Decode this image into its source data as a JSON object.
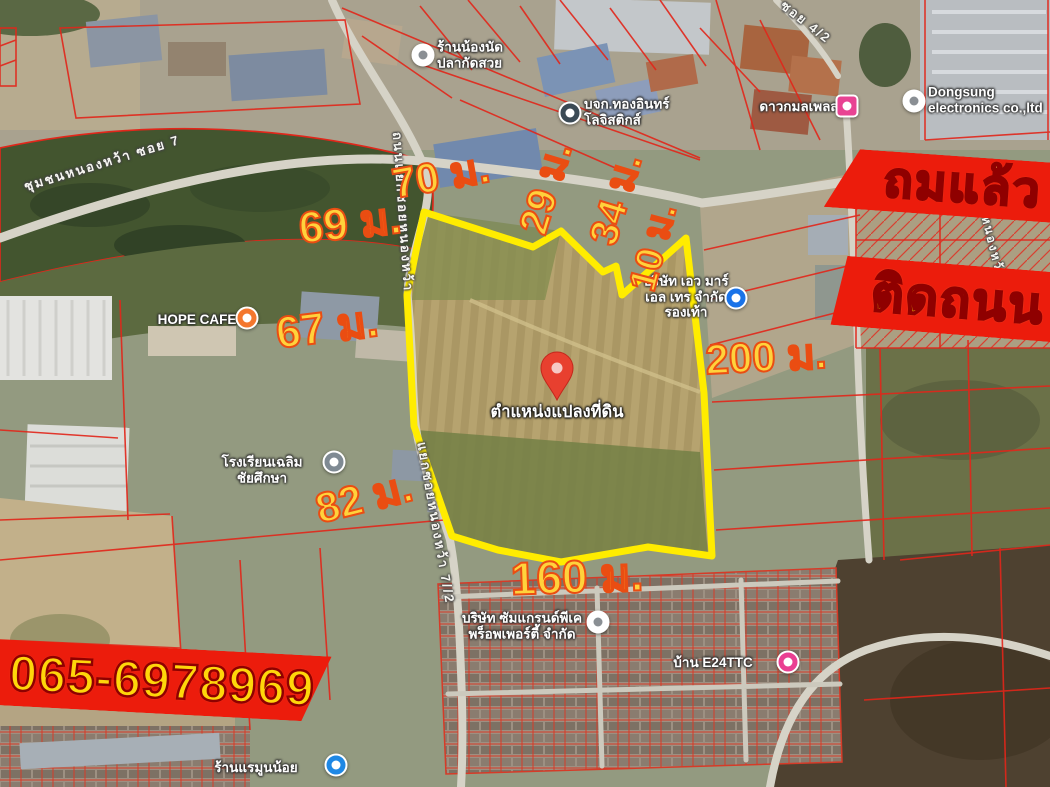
{
  "map": {
    "banners": [
      {
        "id": "filled",
        "text": "ถมแล้ว"
      },
      {
        "id": "next-to-road",
        "text": "ติดถนน"
      },
      {
        "id": "phone",
        "text": "065-6978969"
      }
    ],
    "measurements": [
      {
        "side": "top-left-edge",
        "text": "70 ม."
      },
      {
        "side": "upper-left",
        "text": "69 ม."
      },
      {
        "side": "top-notch-1",
        "text": "29 ม."
      },
      {
        "side": "top-notch-2",
        "text": "34 ม."
      },
      {
        "side": "top-notch-3",
        "text": "10 ม."
      },
      {
        "side": "left",
        "text": "67 ม."
      },
      {
        "side": "right",
        "text": "200 ม."
      },
      {
        "side": "lower-left",
        "text": "82 ม."
      },
      {
        "side": "bottom",
        "text": "160 ม."
      }
    ],
    "pin": {
      "label": "ตำแหน่งแปลงที่ดิน",
      "color": "#e8402f"
    },
    "pois": [
      {
        "id": "fish-shop",
        "lines": [
          "ร้านน้องนัด",
          "ปลากัดสวย"
        ],
        "marker": "shop-marker",
        "color": "#ffffff"
      },
      {
        "id": "logistics",
        "lines": [
          "บจก.ทองอินทร์",
          "โลจิสติกส์"
        ],
        "marker": "business-marker",
        "color": "#3b4a55"
      },
      {
        "id": "daokamol-place",
        "lines": [
          "ดาวกมลเพลส"
        ],
        "marker": "hotel-marker",
        "color": "#e84393"
      },
      {
        "id": "dongsung",
        "lines": [
          "Dongsung",
          "electronics co.,ltd"
        ],
        "marker": "factory-marker",
        "color": "#ffffff"
      },
      {
        "id": "hope-cafe",
        "lines": [
          "HOPE CAFE"
        ],
        "marker": "cafe-marker",
        "color": "#f4772e"
      },
      {
        "id": "school",
        "lines": [
          "โรงเรียนเฉลิม",
          "ชัยศึกษา"
        ],
        "marker": "school-marker",
        "color": "#7f8a93"
      },
      {
        "id": "mart",
        "lines": [
          "บริษัท เอว มาร์",
          "เอล เทร จำกัด",
          "รองเท้า"
        ],
        "marker": "store-marker",
        "color": "#1a73e8"
      },
      {
        "id": "property",
        "lines": [
          "บริษัท ซัมแกรนด์พีเค",
          "พร็อพเพอร์ตี้ จำกัด"
        ],
        "marker": "business-marker",
        "color": "#ffffff"
      },
      {
        "id": "baan-e24ttc",
        "lines": [
          "บ้าน E24TTC"
        ],
        "marker": "home-marker",
        "color": "#ea3f92"
      },
      {
        "id": "ram-noi-shop",
        "lines": [
          "ร้านแรมูนน้อย"
        ],
        "marker": "pet-marker",
        "color": "#1e88e5"
      }
    ],
    "roads": [
      {
        "id": "soi7",
        "text": "ชุมชนหนองหว้า ซอย 7"
      },
      {
        "id": "soi72-upper",
        "text": "ถนนแยกซอยหนองหว้า"
      },
      {
        "id": "soi72-lower",
        "text": "แยกซอยหนองหว้า 7//2"
      },
      {
        "id": "right-road",
        "text": "ชุมชนหนองหว้า"
      },
      {
        "id": "soi42",
        "text": "ซอย 4/2"
      }
    ],
    "colors": {
      "banner_bg": "#ec1c0c",
      "banner_text": "#ffd60a",
      "measure_text": "#ffd23c",
      "measure_outline": "#ea4d12",
      "plot_outline": "#ffec00",
      "cadastral_line": "#e2261a"
    }
  }
}
